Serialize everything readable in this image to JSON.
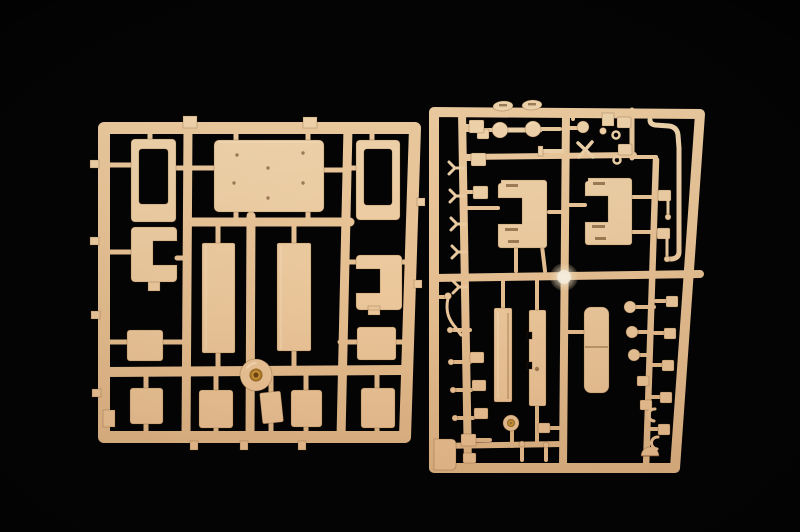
{
  "scene": {
    "type": "photograph",
    "description": "Macro photograph of two tan plastic injection-molded model kit sprues (part trees) lying side by side on a black studio background",
    "visible_text": "none",
    "lighting": "warm directional light, soft falloff toward the bottom"
  },
  "colors": {
    "background": "#040404",
    "plastic_light": "#f4d9b0",
    "plastic_base": "#e2b586",
    "plastic_rail_light": "#f1cfa3",
    "plastic_rail_dark": "#d9ad7d",
    "plastic_edge": "#8a5f33",
    "gold_insert": "#c79032",
    "node_glow": "#f6ead2"
  },
  "sprues": {
    "left": {
      "name": "left sprue",
      "description": "square frame with large flat panels",
      "parts": [
        "roof panel with ejector-pin marks",
        "window-frame panel (left)",
        "window-frame panel (right)",
        "C-bracket panel (left)",
        "C-bracket panel (right)",
        "floor plate (left)",
        "floor plate (right)",
        "side hatch (left)",
        "side hatch (right)",
        "round wheel hub with brass-colored center",
        "five small hatch plates along the bottom row"
      ]
    },
    "right": {
      "name": "right sprue",
      "description": "tall frame densely packed with small detail parts",
      "parts": [
        "cab side panel (left)",
        "cab side panel (right)",
        "twin seat cushions",
        "long instrument strip",
        "narrow side panel",
        "dumbbell axle with two round knobs",
        "two oval grab handles on the top rail",
        "small sphere knob",
        "three ball-head pins",
        "curved exhaust pipe",
        "thin whip rod",
        "small road wheel",
        "dome cap",
        "five Y-shaped clips",
        "eyelet brackets, pads and pins",
        "translucent injection node",
        "corner filler block"
      ]
    }
  }
}
